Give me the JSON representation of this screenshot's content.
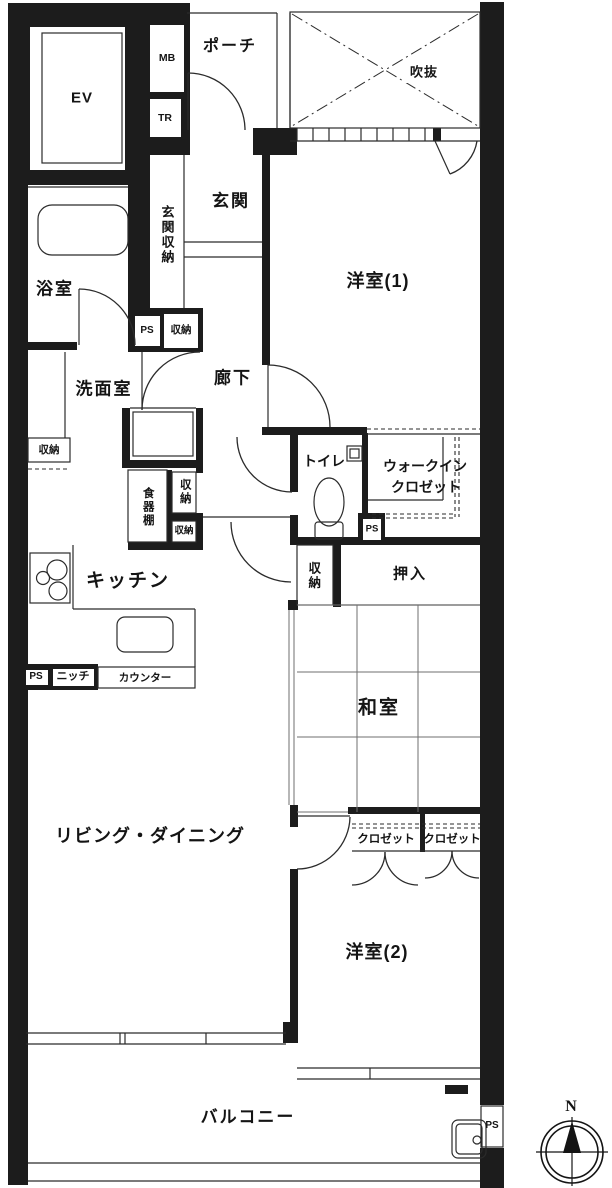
{
  "plan": {
    "labels": {
      "ev": "EV",
      "mb": "MB",
      "tr": "TR",
      "porch": "ポーチ",
      "void": "吹抜",
      "genkan": "玄関",
      "genkan_storage": "玄関収納",
      "bathroom": "浴室",
      "ps1": "PS",
      "storage_top": "収納",
      "washroom": "洗面室",
      "storage_wash": "収納",
      "corridor": "廊下",
      "western1": "洋室(1)",
      "toilet": "トイレ",
      "wic_line1": "ウォークイン",
      "wic_line2": "クロゼット",
      "ps2": "PS",
      "cupboard": "食器棚",
      "storage_k1": "収納",
      "storage_k2": "収納",
      "storage_mid": "収納",
      "oshiire": "押入",
      "kitchen": "キッチン",
      "ps3": "PS",
      "niche": "ニッチ",
      "counter": "カウンター",
      "washitsu": "和室",
      "living": "リビング・ダイニング",
      "closet1": "クロゼット",
      "closet2": "クロゼット",
      "western2": "洋室(2)",
      "balcony": "バルコニー",
      "ps4": "PS",
      "compass_n": "N"
    },
    "colors": {
      "wall": "#1c1c1c",
      "line": "#2b2b2b",
      "bg": "#ffffff"
    }
  }
}
